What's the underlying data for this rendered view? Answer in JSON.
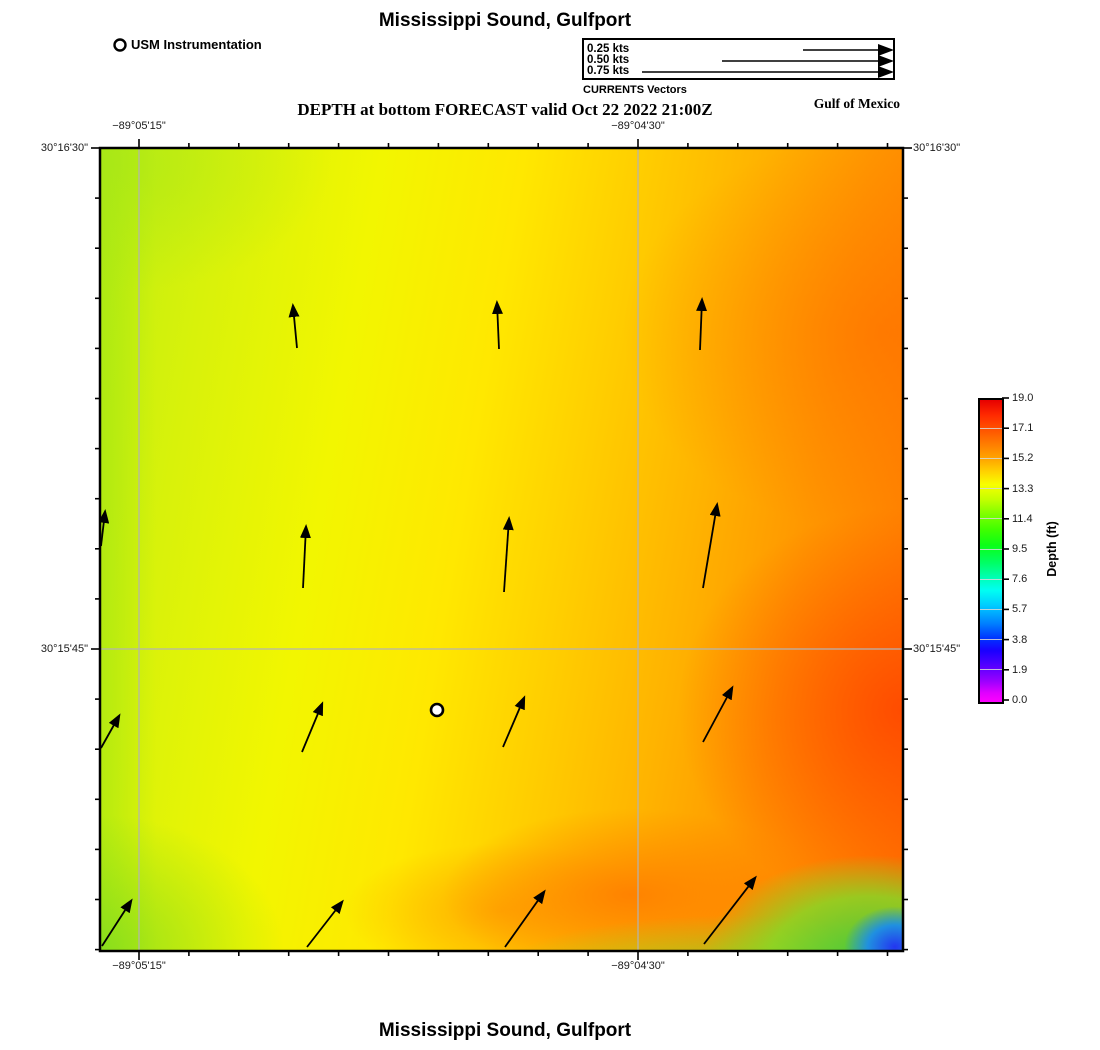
{
  "page": {
    "top_title": "Mississippi Sound, Gulfport",
    "subtitle": "DEPTH at bottom FORECAST valid Oct 22 2022 21:00Z",
    "bottom_title": "Mississippi Sound, Gulfport",
    "region_label": "Gulf of Mexico"
  },
  "station_legend": {
    "label": "USM Instrumentation"
  },
  "vector_legend": {
    "caption": "CURRENTS Vectors",
    "entries": [
      {
        "label": "0.25 kts",
        "speed_kts": 0.25,
        "line_px": 88
      },
      {
        "label": "0.50 kts",
        "speed_kts": 0.5,
        "line_px": 169
      },
      {
        "label": "0.75 kts",
        "speed_kts": 0.75,
        "line_px": 249
      }
    ]
  },
  "axes": {
    "top": [
      {
        "label": "−89°05'15\""
      },
      {
        "label": "−89°04'30\""
      }
    ],
    "bottom": [
      {
        "label": "−89°05'15\""
      },
      {
        "label": "−89°04'30\""
      }
    ],
    "left": [
      {
        "label": "30°16'30\""
      },
      {
        "label": "30°15'45\""
      }
    ],
    "right": [
      {
        "label": "30°16'30\""
      },
      {
        "label": "30°15'45\""
      }
    ]
  },
  "colorbar": {
    "title": "Depth (ft)",
    "ticks": [
      "19.0",
      "17.1",
      "15.2",
      "13.3",
      "11.4",
      "9.5",
      "7.6",
      "5.7",
      "3.8",
      "1.9",
      "0.0"
    ]
  },
  "chart_data": {
    "type": "heatmap",
    "title": "Mississippi Sound, Gulfport",
    "subtitle": "DEPTH at bottom FORECAST valid Oct 22 2022 21:00Z",
    "variable": "Depth (ft)",
    "value_range": [
      0.0,
      19.0
    ],
    "colorbar_ticks": [
      19.0,
      17.1,
      15.2,
      13.3,
      11.4,
      9.5,
      7.6,
      5.7,
      3.8,
      1.9,
      0.0
    ],
    "colormap": "rainbow: magenta(0) → blue → cyan → green → yellow → orange → red(19)",
    "x_axis": {
      "meaning": "longitude",
      "tick_labels": [
        "−89°05'15\"",
        "−89°04'30\""
      ]
    },
    "y_axis": {
      "meaning": "latitude",
      "tick_labels": [
        "30°16'30\"",
        "30°15'45\""
      ]
    },
    "field_summary": "Depth ~13–15 ft (yellow-green) in the west, deepening eastward to ~17–19 ft (orange-red) along the east edge; shallow patch 0–8 ft (green to blue) in the far southeast corner; orange ~16 ft lobe along bottom center.",
    "station": {
      "name": "USM Instrumentation",
      "px": [
        437,
        710
      ]
    },
    "grid_px": {
      "x_gridlines": [
        139,
        638
      ],
      "y_gridlines": [
        649
      ],
      "frame": [
        100,
        148,
        903,
        951
      ]
    },
    "vectors_px": [
      [
        297,
        348,
        293,
        306
      ],
      [
        499,
        349,
        497,
        303
      ],
      [
        700,
        350,
        702,
        300
      ],
      [
        101,
        546,
        105,
        512
      ],
      [
        303,
        588,
        306,
        527
      ],
      [
        504,
        592,
        509,
        519
      ],
      [
        703,
        588,
        717,
        505
      ],
      [
        101,
        748,
        119,
        716
      ],
      [
        302,
        752,
        322,
        704
      ],
      [
        503,
        747,
        524,
        698
      ],
      [
        703,
        742,
        732,
        688
      ],
      [
        102,
        946,
        131,
        901
      ],
      [
        307,
        947,
        342,
        902
      ],
      [
        505,
        947,
        544,
        892
      ],
      [
        704,
        944,
        755,
        878
      ]
    ],
    "legend_speeds_kts": [
      0.25,
      0.5,
      0.75
    ]
  }
}
